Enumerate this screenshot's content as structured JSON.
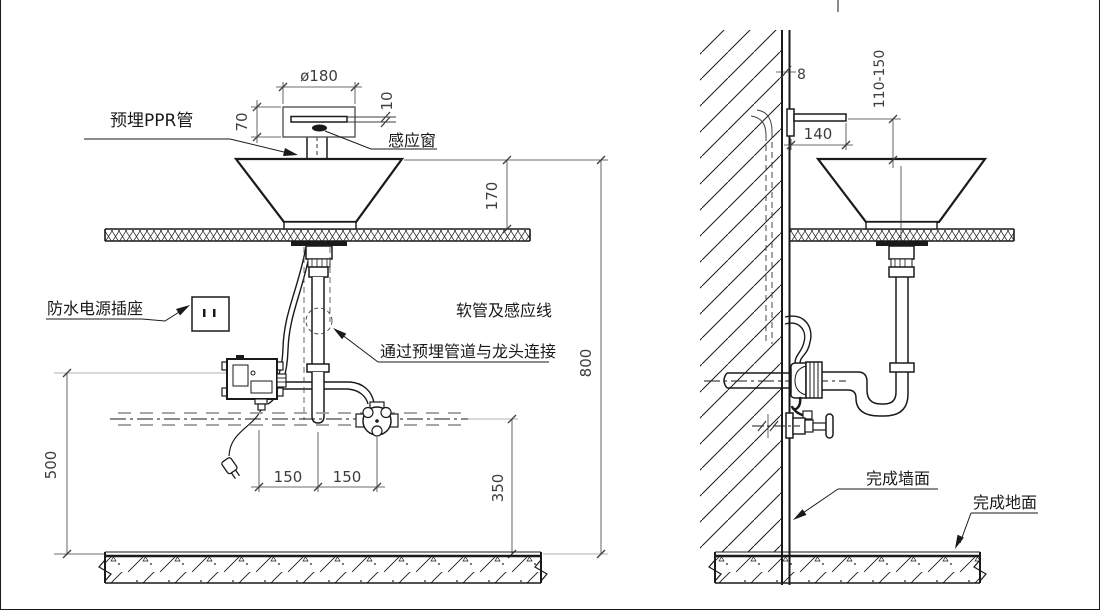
{
  "front_view": {
    "labels": {
      "ppr_pipe": "预埋PPR管",
      "sensor_window": "感应窗",
      "waterproof_socket": "防水电源插座",
      "hose_note_line1": "软管及感应线",
      "hose_note_line2": "通过预埋管道与龙头连接"
    },
    "dimensions": {
      "spout_diameter": "ø180",
      "spout_body_height": "70",
      "sensor_slot": "10",
      "basin_above_counter": "170",
      "rim_above_floor": "800",
      "socket_above_floor": "500",
      "offset_left": "150",
      "offset_right": "150",
      "supply_above_floor": "350"
    }
  },
  "side_view": {
    "labels": {
      "finished_wall": "完成墙面",
      "finished_floor": "完成地面"
    },
    "dimensions": {
      "wall_finish_thickness": "8",
      "spout_projection": "140",
      "spout_to_rim_range": "110-150"
    }
  },
  "colors": {
    "line": "#1a1a1a",
    "dim_line": "#3d3d3d",
    "hidden_line": "#999999",
    "background": "#ffffff"
  }
}
